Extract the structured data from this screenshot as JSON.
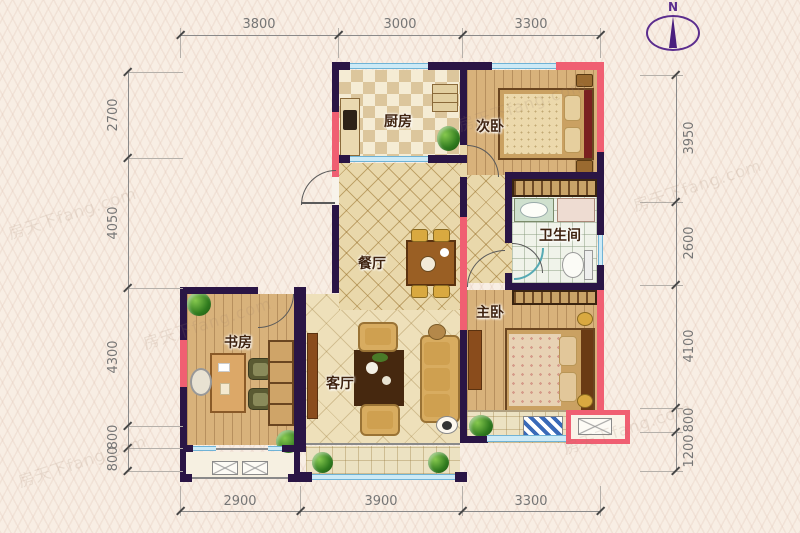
{
  "page": {
    "type": "apartment-floor-plan"
  },
  "compass": {
    "label": "N"
  },
  "rooms": {
    "kitchen": {
      "label": "厨房"
    },
    "secondary_bedroom": {
      "label": "次卧"
    },
    "dining": {
      "label": "餐厅"
    },
    "bathroom": {
      "label": "卫生间"
    },
    "master_bedroom": {
      "label": "主卧"
    },
    "study": {
      "label": "书房"
    },
    "living": {
      "label": "客厅"
    }
  },
  "dimensions": {
    "top": [
      "3800",
      "3000",
      "3300"
    ],
    "bottom": [
      "2900",
      "3900",
      "3300"
    ],
    "left": [
      "2700",
      "4050",
      "4300",
      "800",
      "800"
    ],
    "right": [
      "3950",
      "2600",
      "4100",
      "800",
      "1200"
    ]
  },
  "watermark": {
    "text": "房天下fang.com"
  },
  "colors": {
    "wall": "#2a1545",
    "accent": "#f05f72",
    "window": "#cdeaf6",
    "compass": "#5b2d8e",
    "dimension_text": "#767676"
  }
}
